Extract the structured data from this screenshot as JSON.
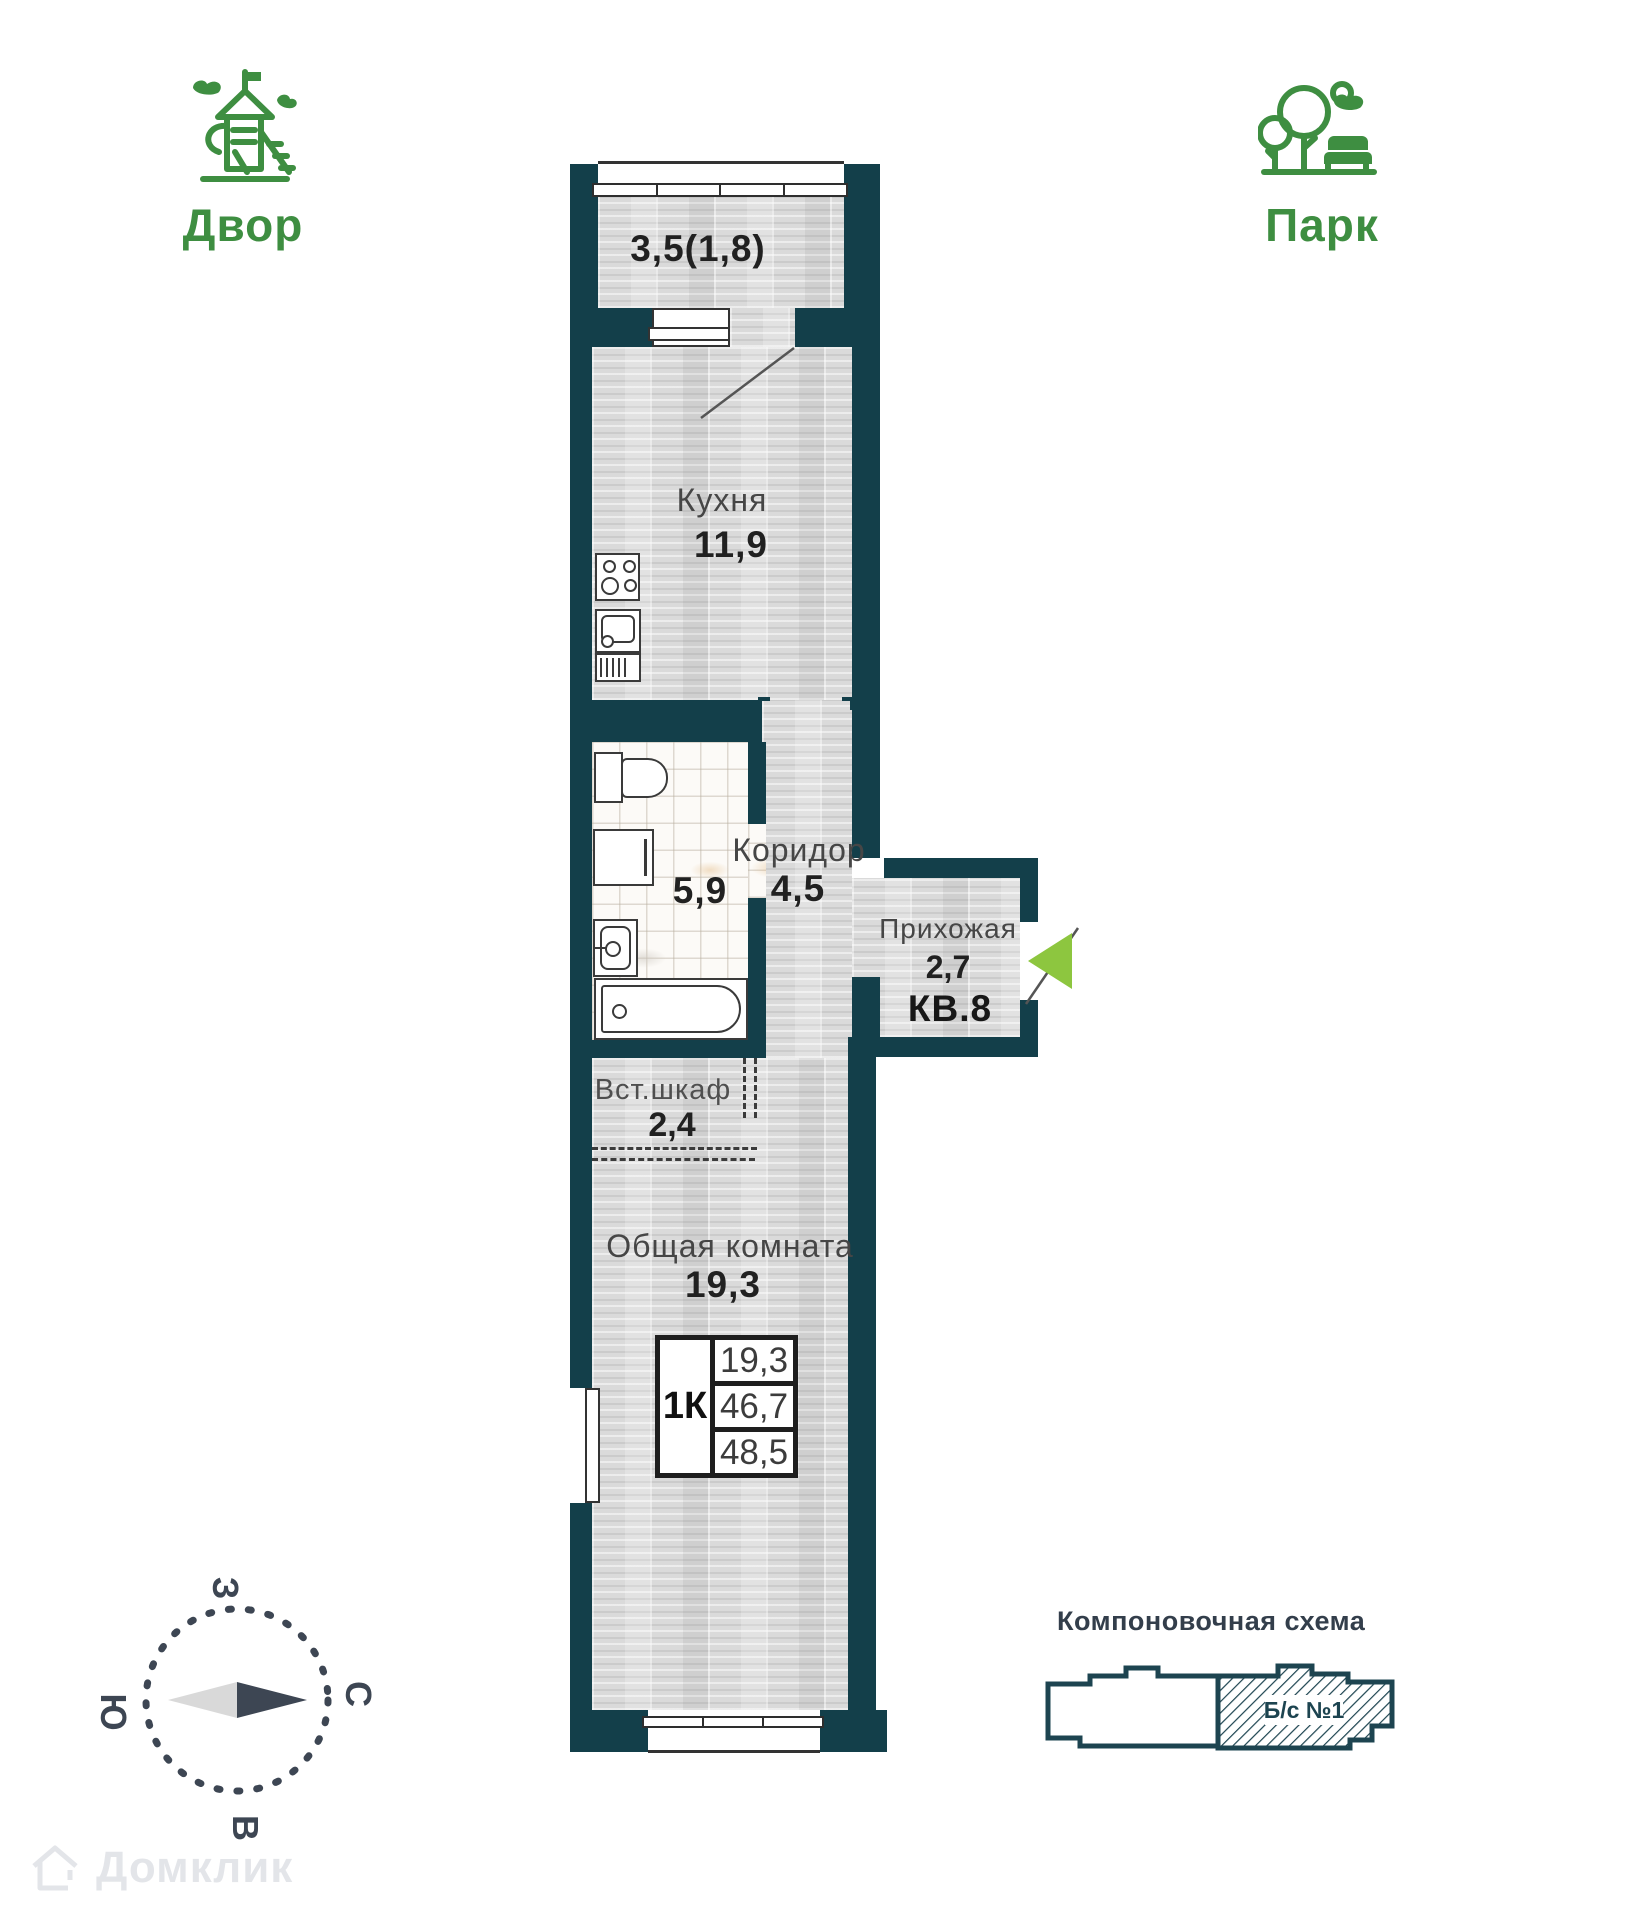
{
  "legend": {
    "yard": "Двор",
    "park": "Парк"
  },
  "colors": {
    "wall": "#133f4a",
    "green": "#3e8e41",
    "arrow": "#8dc63f",
    "compass": "#3d4653"
  },
  "rooms": {
    "balcony": {
      "area": "3,5(1,8)"
    },
    "kitchen": {
      "name": "Кухня",
      "area": "11,9"
    },
    "bathroom": {
      "area": "5,9"
    },
    "corridor": {
      "name": "Коридор",
      "area": "4,5"
    },
    "hallway": {
      "name": "Прихожая",
      "area": "2,7",
      "apt": "КВ.8"
    },
    "closet": {
      "name": "Вст.шкаф",
      "area": "2,4"
    },
    "living": {
      "name": "Общая комната",
      "area": "19,3"
    }
  },
  "info_table": {
    "type": "1К",
    "living_area": "19,3",
    "apartment_area": "46,7",
    "total_area": "48,5"
  },
  "compass": {
    "n": "С",
    "s": "Ю",
    "w": "З",
    "e": "В"
  },
  "schematic": {
    "title": "Компоновочная схема",
    "block": "Б/с №1"
  },
  "watermark": "Домклик"
}
